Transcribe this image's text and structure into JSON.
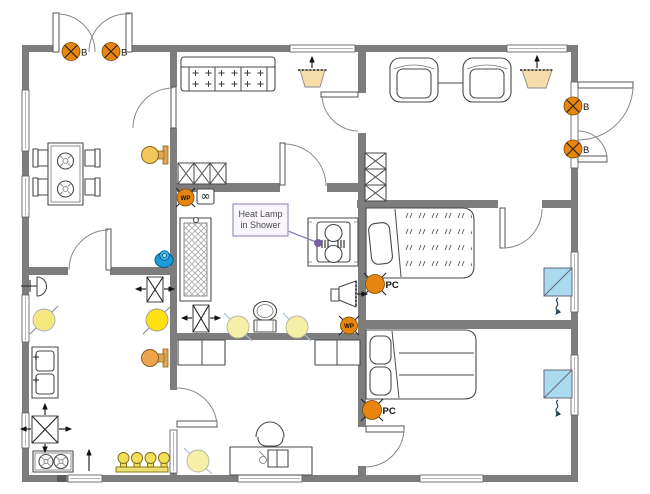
{
  "diagram": {
    "type": "home-electrical-floor-plan",
    "callout": {
      "line1": "Heat Lamp",
      "line2": "in Shower"
    },
    "receptacle_labels": {
      "b": "B",
      "pc": "PC",
      "wp": "WP",
      "infinity": "∞"
    },
    "symbol_names": [
      "blanked-receptacle-b",
      "computer-receptacle-pc",
      "weatherproof-receptacle-wp",
      "special-receptacle-infinity",
      "recessed-ceiling-light",
      "wall-sconce-light",
      "exhaust-fan",
      "ceiling-vent",
      "wall-speaker",
      "doorbell",
      "smoke-detector",
      "air-conditioner",
      "vanity-light-bar",
      "heat-lamp"
    ],
    "colors": {
      "wall-gray": "#7d7d7d",
      "orange": "#e8850f",
      "yellow-bright": "#ffe112",
      "yellow-mid": "#f5e87f",
      "yellow-pale": "#f5efa8",
      "tan": "#f6dca8",
      "sconce": "#f1c75b",
      "sconce2": "#eca44f",
      "sconce-arm": "#dfa657",
      "blue": "#1e9cd7",
      "ac-blue": "#aadaf0",
      "bulb": "#f2de58",
      "callout-fill": "#f8f6fc",
      "callout-border": "#ac9ec9",
      "purple": "#8f7fbf",
      "purple-dot": "#7b5fa5"
    }
  }
}
